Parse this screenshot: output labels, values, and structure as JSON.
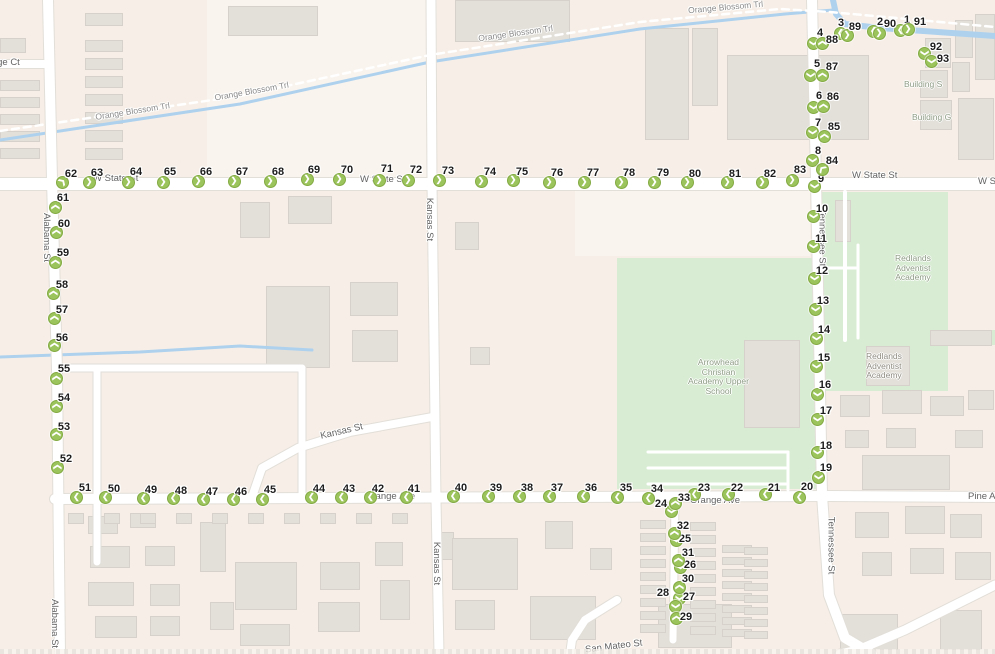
{
  "map": {
    "background": "#f7efe7",
    "colors": {
      "marker_fill": "#9cc45c",
      "marker_border": "#83aa43",
      "park_green": "#d8ecd3",
      "water_blue": "#aed1ee",
      "road_white": "#ffffff",
      "building_gray": "#e3e0da"
    },
    "street_labels": {
      "w_state_st": "W State St",
      "orange_blossom_trl": "Orange Blossom Trl",
      "alabama_st": "Alabama St",
      "kansas_st": "Kansas St",
      "tennessee_st": "Tennessee St",
      "orange_ave": "Orange Ave",
      "pine_ave": "Pine Ave",
      "orange_ct": "Orange Ct",
      "san_mateo_st": "San Mateo St"
    },
    "pois": {
      "building_s": "Building S",
      "building_g": "Building G",
      "redlands_adventist_academy": [
        "Redlands",
        "Adventist",
        "Academy"
      ],
      "arrowhead_christian_academy": [
        "Arrowhead",
        "Christian",
        "Academy Upper",
        "School"
      ]
    },
    "markers": [
      [
        1,
        900,
        30,
        "l",
        907,
        20
      ],
      [
        2,
        873,
        31,
        "l",
        880,
        22
      ],
      [
        3,
        840,
        33,
        "l",
        841,
        23
      ],
      [
        4,
        813,
        43,
        "d",
        820,
        33
      ],
      [
        5,
        810,
        75,
        "d",
        817,
        64
      ],
      [
        6,
        813,
        107,
        "d",
        819,
        96
      ],
      [
        7,
        812,
        132,
        "d",
        818,
        123
      ],
      [
        8,
        812,
        160,
        "d",
        818,
        151
      ],
      [
        9,
        814,
        186,
        "d",
        821,
        179
      ],
      [
        10,
        813,
        216,
        "d",
        822,
        209
      ],
      [
        11,
        813,
        246,
        "d",
        821,
        239
      ],
      [
        12,
        814,
        278,
        "d",
        822,
        271
      ],
      [
        13,
        815,
        309,
        "d",
        823,
        301
      ],
      [
        14,
        816,
        338,
        "d",
        824,
        330
      ],
      [
        15,
        816,
        366,
        "d",
        824,
        358
      ],
      [
        16,
        817,
        394,
        "d",
        825,
        385
      ],
      [
        17,
        817,
        419,
        "d",
        826,
        411
      ],
      [
        18,
        817,
        452,
        "d",
        826,
        446
      ],
      [
        19,
        818,
        477,
        "d",
        826,
        468
      ],
      [
        20,
        799,
        497,
        "l",
        807,
        487
      ],
      [
        21,
        765,
        494,
        "l",
        774,
        488
      ],
      [
        22,
        728,
        494,
        "l",
        737,
        488
      ],
      [
        23,
        694,
        494,
        "l",
        704,
        488
      ],
      [
        24,
        671,
        511,
        "d",
        661,
        504
      ],
      [
        25,
        676,
        540,
        "d",
        685,
        539
      ],
      [
        26,
        680,
        567,
        "d",
        690,
        565
      ],
      [
        27,
        679,
        598,
        "d",
        689,
        597
      ],
      [
        28,
        675,
        606,
        "d",
        663,
        593
      ],
      [
        29,
        676,
        618,
        "u",
        686,
        617
      ],
      [
        30,
        679,
        587,
        "u",
        688,
        579
      ],
      [
        31,
        678,
        560,
        "u",
        688,
        553
      ],
      [
        32,
        674,
        533,
        "u",
        683,
        526
      ],
      [
        33,
        675,
        503,
        "u",
        684,
        498
      ],
      [
        34,
        648,
        498,
        "l",
        657,
        489
      ],
      [
        35,
        617,
        497,
        "l",
        626,
        488
      ],
      [
        36,
        583,
        496,
        "l",
        591,
        488
      ],
      [
        37,
        549,
        496,
        "l",
        557,
        488
      ],
      [
        38,
        519,
        496,
        "l",
        527,
        488
      ],
      [
        39,
        488,
        496,
        "l",
        496,
        488
      ],
      [
        40,
        453,
        496,
        "l",
        461,
        488
      ],
      [
        41,
        406,
        497,
        "l",
        414,
        489
      ],
      [
        42,
        370,
        497,
        "l",
        378,
        489
      ],
      [
        43,
        341,
        497,
        "l",
        349,
        489
      ],
      [
        44,
        311,
        497,
        "l",
        319,
        489
      ],
      [
        45,
        262,
        499,
        "l",
        270,
        490
      ],
      [
        46,
        233,
        499,
        "l",
        241,
        492
      ],
      [
        47,
        203,
        499,
        "l",
        212,
        492
      ],
      [
        48,
        173,
        498,
        "l",
        181,
        491
      ],
      [
        49,
        143,
        498,
        "l",
        151,
        490
      ],
      [
        50,
        105,
        497,
        "l",
        114,
        489
      ],
      [
        51,
        76,
        497,
        "l",
        85,
        488
      ],
      [
        52,
        57,
        467,
        "u",
        66,
        459
      ],
      [
        53,
        56,
        434,
        "u",
        64,
        427
      ],
      [
        54,
        56,
        406,
        "u",
        64,
        398
      ],
      [
        55,
        56,
        378,
        "u",
        64,
        369
      ],
      [
        56,
        54,
        345,
        "u",
        62,
        338
      ],
      [
        57,
        54,
        318,
        "u",
        62,
        310
      ],
      [
        58,
        53,
        293,
        "u",
        62,
        285
      ],
      [
        59,
        55,
        262,
        "u",
        63,
        253
      ],
      [
        60,
        56,
        232,
        "u",
        64,
        224
      ],
      [
        61,
        55,
        207,
        "u",
        63,
        198
      ],
      [
        62,
        62,
        182,
        "ur",
        71,
        174
      ],
      [
        63,
        89,
        182,
        "r",
        97,
        173
      ],
      [
        64,
        128,
        182,
        "r",
        136,
        172
      ],
      [
        65,
        163,
        182,
        "r",
        170,
        172
      ],
      [
        66,
        198,
        181,
        "r",
        206,
        172
      ],
      [
        67,
        234,
        181,
        "r",
        242,
        172
      ],
      [
        68,
        270,
        181,
        "r",
        278,
        172
      ],
      [
        69,
        307,
        179,
        "r",
        314,
        170
      ],
      [
        70,
        339,
        179,
        "r",
        347,
        170
      ],
      [
        71,
        379,
        180,
        "r",
        387,
        169
      ],
      [
        72,
        408,
        180,
        "r",
        416,
        170
      ],
      [
        73,
        439,
        180,
        "r",
        448,
        171
      ],
      [
        74,
        481,
        181,
        "r",
        490,
        172
      ],
      [
        75,
        513,
        180,
        "r",
        522,
        172
      ],
      [
        76,
        549,
        182,
        "r",
        557,
        173
      ],
      [
        77,
        584,
        182,
        "r",
        593,
        173
      ],
      [
        78,
        621,
        182,
        "r",
        629,
        173
      ],
      [
        79,
        654,
        182,
        "r",
        663,
        173
      ],
      [
        80,
        687,
        182,
        "r",
        695,
        174
      ],
      [
        81,
        727,
        182,
        "r",
        735,
        174
      ],
      [
        82,
        762,
        182,
        "r",
        770,
        174
      ],
      [
        83,
        792,
        180,
        "r",
        800,
        170
      ],
      [
        84,
        822,
        169,
        "ul",
        832,
        161
      ],
      [
        85,
        824,
        136,
        "u",
        834,
        127
      ],
      [
        86,
        823,
        106,
        "u",
        833,
        97
      ],
      [
        87,
        822,
        75,
        "u",
        832,
        67
      ],
      [
        88,
        822,
        43,
        "u",
        832,
        40
      ],
      [
        89,
        847,
        35,
        "r",
        855,
        27
      ],
      [
        90,
        879,
        33,
        "r",
        890,
        24
      ],
      [
        91,
        908,
        29,
        "r",
        920,
        22
      ],
      [
        92,
        924,
        53,
        "d",
        936,
        47
      ],
      [
        93,
        931,
        61,
        "d",
        943,
        59
      ]
    ]
  }
}
